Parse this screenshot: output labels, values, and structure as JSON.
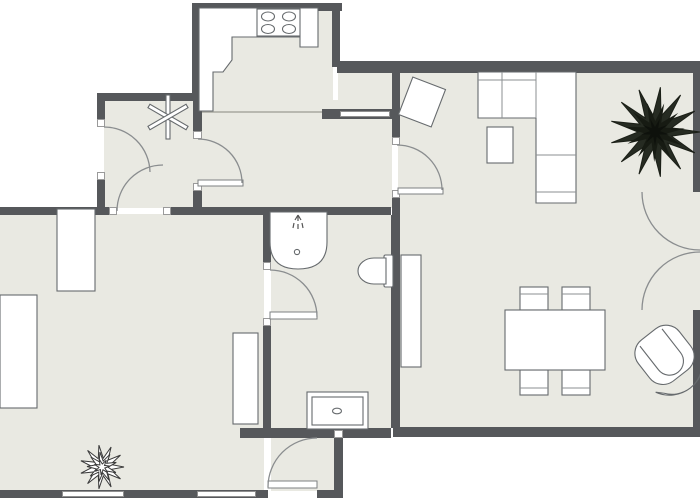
{
  "app": {
    "type": "floor-plan-2d-view",
    "visible_text": ""
  },
  "palette": {
    "background": "#ffffff",
    "wall": "#56585b",
    "floor": "#e9e9e2",
    "fixture_fill": "#ffffff",
    "fixture_outline": "#666a6d",
    "door_arc": "#8a8d8f",
    "plant_dark": "#23281e",
    "plant_light_outline": "#3a3a3a"
  },
  "plan": {
    "regions": [
      "kitchen",
      "hallway",
      "inner-hall",
      "bathroom",
      "bedroom",
      "entry-vestibule",
      "living-dining-room"
    ],
    "kitchen": {
      "fixtures": [
        "kitchen-counter",
        "stove-4-burners"
      ]
    },
    "hallway": {
      "symbols": [
        "ceiling-fan-symbol"
      ]
    },
    "bathroom": {
      "fixtures": [
        "shower-with-head",
        "toilet",
        "sink-vanity"
      ]
    },
    "bedroom": {
      "furniture": [
        "wardrobe",
        "bed",
        "dresser",
        "potted-plant-outline"
      ]
    },
    "living_room": {
      "furniture": [
        "corner-sofa",
        "coffee-table",
        "tilted-media-unit",
        "sideboard",
        "dining-table",
        "dining-chairs-x4",
        "armchair-rotated",
        "large-dark-plant"
      ]
    },
    "doors": [
      {
        "id": "hallway-left-door",
        "type": "single-swing"
      },
      {
        "id": "kitchen-door",
        "type": "single-swing"
      },
      {
        "id": "bedroom-door",
        "type": "single-swing"
      },
      {
        "id": "bathroom-door",
        "type": "single-swing-with-leaf"
      },
      {
        "id": "living-room-door",
        "type": "single-swing-with-leaf"
      },
      {
        "id": "entry-door",
        "type": "single-swing-with-leaf"
      },
      {
        "id": "balcony-french-doors",
        "type": "double-swing"
      }
    ],
    "windows": [
      {
        "id": "bedroom-window-1",
        "wall": "bottom"
      },
      {
        "id": "bedroom-window-2",
        "wall": "bottom"
      },
      {
        "id": "interior-window",
        "wall": "kitchen-living-divider"
      }
    ],
    "counts": {
      "stove_burners": 4,
      "dining_chairs": 4,
      "plants": 2
    }
  }
}
